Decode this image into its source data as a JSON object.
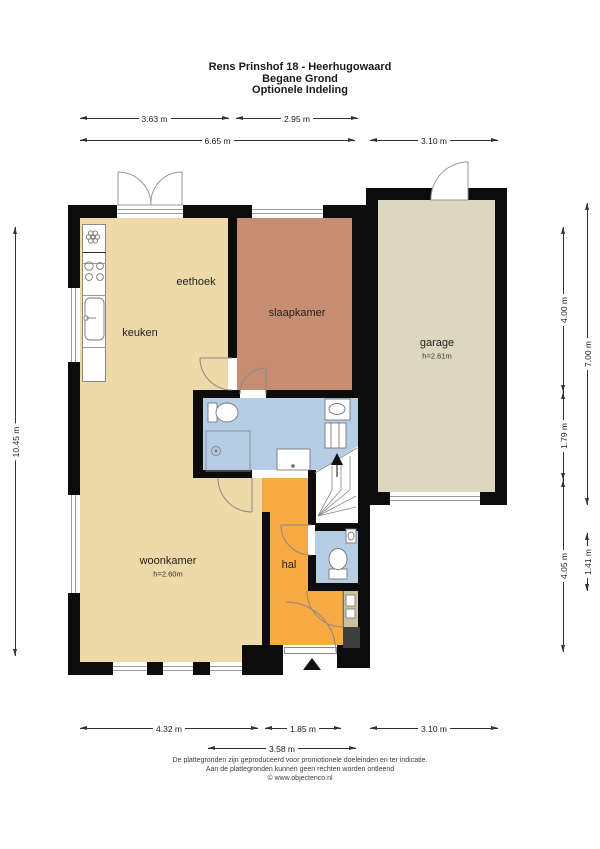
{
  "header": {
    "title": "Rens Prinshof 18 - Heerhugowaard",
    "subtitle1": "Begane Grond",
    "subtitle2": "Optionele Indeling"
  },
  "rooms": {
    "eethoek": "eethoek",
    "keuken": "keuken",
    "slaapkamer": "slaapkamer",
    "garage": "garage",
    "garage_h": "h=2.61m",
    "woonkamer": "woonkamer",
    "woonkamer_h": "h=2.60m",
    "hal": "hal"
  },
  "dims": {
    "d363": "3.63 m",
    "d295": "2.95 m",
    "d665": "6.65 m",
    "d310t": "3.10 m",
    "d1045": "10.45 m",
    "d400": "4.00 m",
    "d179": "1.79 m",
    "d405": "4.05 m",
    "d700": "7.00 m",
    "d141": "1.41 m",
    "d432": "4.32 m",
    "d185": "1.85 m",
    "d310b": "3.10 m",
    "d358": "3.58 m"
  },
  "footer": {
    "line1": "De plattegronden zijn geproduceerd voor promotionele doeleinden en ter indicatie.",
    "line2": "Aan de plattegronden kunnen geen rechten worden ontleend",
    "line3": "© www.objectenco.nl"
  },
  "colors": {
    "wall": "#0c0c0c",
    "living": "#eed9a8",
    "bedroom": "#c68d72",
    "garage": "#ddd7c0",
    "bath": "#b6cde6",
    "hall": "#f7a943",
    "meter": "#cdc0a0",
    "darkbox": "#3f3f3f"
  }
}
